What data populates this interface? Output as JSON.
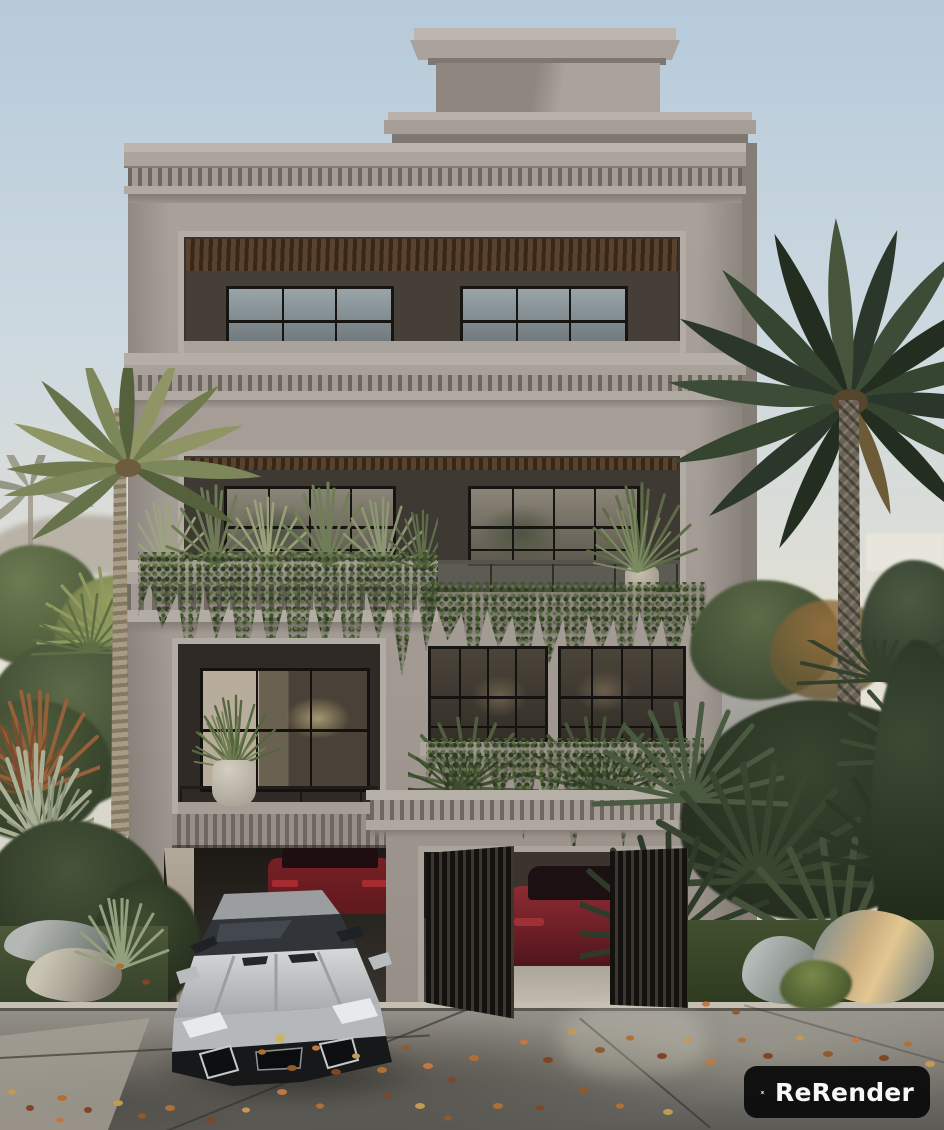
{
  "image": {
    "kind": "3D architectural exterior render",
    "subject": "Three-storey neoclassical stucco villa with stepped penthouse roof, dentil cornices, recessed black-framed window bays, planted balconies with trailing ivy and agaves, twin street-level garages",
    "setting": "Overcast coastal street flanked by date palms and tropical shrubs, boulders on both sides, wet concrete sidewalk scattered with fallen autumn leaves",
    "vehicles": [
      "silver supercar parked in the left driveway exit",
      "red coupe parked deeper inside the left driveway",
      "dark red sedan inside the right garage behind a slatted gate"
    ]
  },
  "watermark": {
    "label": "ReRender",
    "icon": "rerender-logo-icon"
  },
  "palette": {
    "sky_top": "#b6cada",
    "sky_mid": "#cdd9e0",
    "sky_low": "#dfded5",
    "haze": "#e7e3d6",
    "hill": "#8e7f6f",
    "white_wall": "#e7e5dc",
    "facade": "#a7a098",
    "facade_light": "#b7b0a8",
    "facade_dark": "#8e8780",
    "facade_deep": "#7c756e",
    "cornice_shadow": "#6f6861",
    "loggia_dark": "#3b362f",
    "wall_inner": "#4a443c",
    "wood": "#553f2a",
    "frame_black": "#171512",
    "glass_sky": "#99a4a8",
    "glass_deep": "#6e787c",
    "glass_warm": "#8b8478",
    "curtain": "#b3a995",
    "ivy_dark": "#2d3a24",
    "ivy_mid": "#42522f",
    "ivy_light": "#5d7040",
    "spike_pale": "#9ba37f",
    "spike_mid": "#6d7a55",
    "palmL_light": "#8f9564",
    "palmL_mid": "#6f7b4c",
    "palmL_dark": "#55613c",
    "palmR_light": "#4c5a42",
    "palmR_mid": "#36452f",
    "palmR_dark": "#232e21",
    "trunk_light": "#a49a87",
    "trunk_dark": "#6e6556",
    "bush": "#4e5c3b",
    "bush_light": "#7c8a55",
    "bush_dark": "#2c3522",
    "dry_red": "#95603a",
    "agave": "#a9b096",
    "grass": "#44522f",
    "street": "#96938c",
    "street_dark": "#6b6963",
    "street_deep": "#5d5b55",
    "curb": "#c4bfb2",
    "leaf_orange": "#b06f35",
    "leaf_rust": "#7e4526",
    "leaf_gold": "#c29a52",
    "car_silver": "#c6c8ca",
    "car_glass": "#2e3134",
    "car_red": "#801f23",
    "car_maroon": "#6d1f26",
    "gate_slat": "#3e372e",
    "rock": "#9aa09e",
    "rock_warm": "#c8ab7e",
    "pot": "#c8c2b4",
    "wm_bg": "#0b0b0b",
    "wm_fg": "#ffffff"
  }
}
